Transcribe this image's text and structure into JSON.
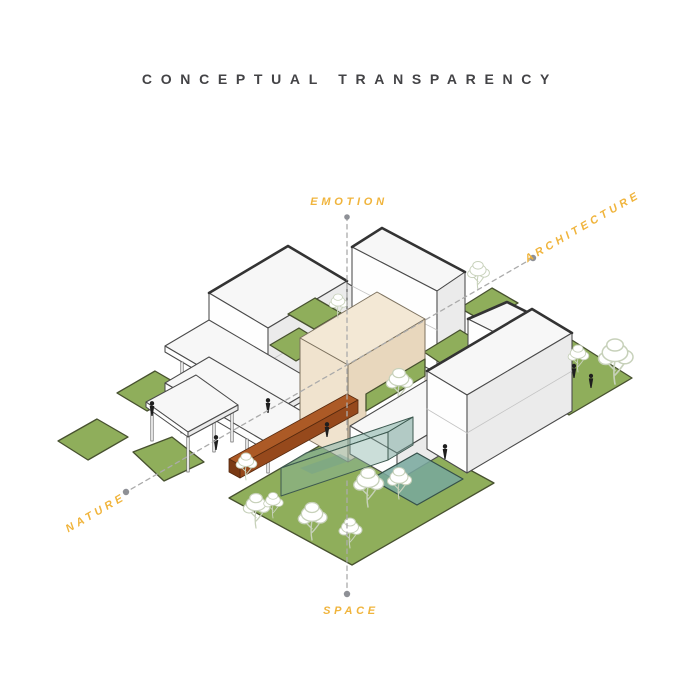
{
  "title": "CONCEPTUAL TRANSPARENCY",
  "axes": {
    "top": {
      "label": "EMOTION"
    },
    "bottom": {
      "label": "SPACE"
    },
    "upper_right": {
      "label": "ARCHITECTURE"
    },
    "lower_left": {
      "label": "NATURE"
    }
  },
  "colors": {
    "accent": "#F0B43C",
    "title": "#434346",
    "outline": "#4A4A4A",
    "outlineHeavy": "#333333",
    "faceWhite": "#FEFEFE",
    "faceShade": "#EBEBEB",
    "faceTop": "#F7F7F7",
    "grass": "#8FAE5B",
    "grassStroke": "#47512F",
    "beigeTop": "#F3E8D5",
    "beigeLeft": "#F0E3CE",
    "beigeRight": "#E8D7BD",
    "rustTop": "#AC5A26",
    "rustFront": "#96491C",
    "rustEnd": "#7A3A14",
    "dashLine": "#ABABAB",
    "dotGray": "#8E9096",
    "treeStroke": "#C7D1BA",
    "person": "#1E1E1E"
  }
}
